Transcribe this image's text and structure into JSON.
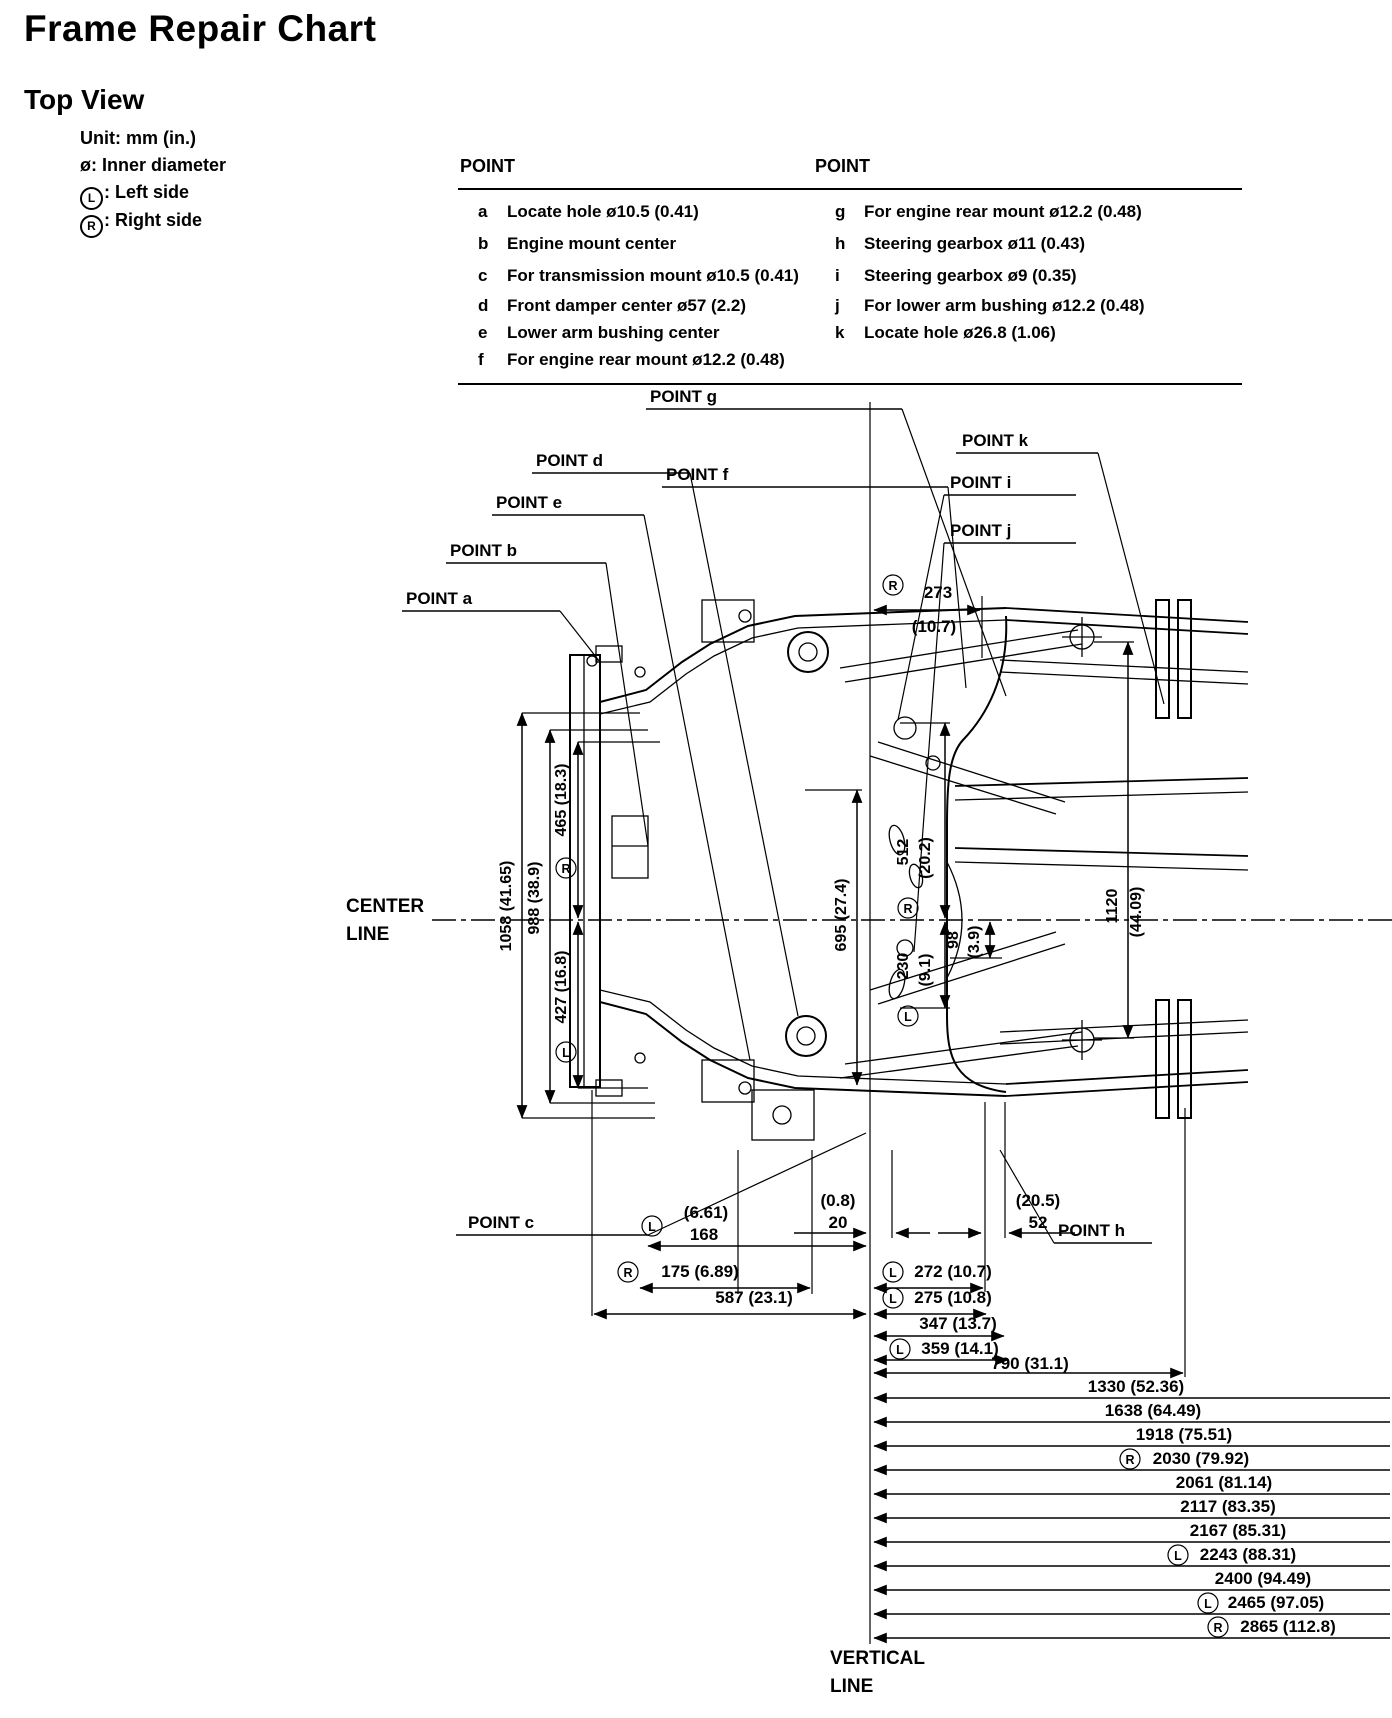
{
  "page": {
    "title": "Frame Repair Chart",
    "subtitle": "Top View"
  },
  "legend": {
    "unit": "Unit: mm (in.)",
    "diameter": "ø: Inner diameter",
    "left_symbol": "L",
    "left_label": ": Left side",
    "right_symbol": "R",
    "right_label": ": Right side"
  },
  "table": {
    "left_header": "POINT",
    "right_header": "POINT",
    "left_rows": [
      {
        "key": "a",
        "desc": "Locate hole ø10.5 (0.41)"
      },
      {
        "key": "b",
        "desc": "Engine mount center"
      },
      {
        "key": "c",
        "desc": "For transmission mount ø10.5 (0.41)"
      },
      {
        "key": "d",
        "desc": "Front damper center ø57 (2.2)"
      },
      {
        "key": "e",
        "desc": "Lower arm bushing center"
      },
      {
        "key": "f",
        "desc": "For engine rear mount ø12.2 (0.48)"
      }
    ],
    "right_rows": [
      {
        "key": "g",
        "desc": "For engine rear mount ø12.2 (0.48)"
      },
      {
        "key": "h",
        "desc": "Steering gearbox ø11 (0.43)"
      },
      {
        "key": "i",
        "desc": "Steering gearbox ø9 (0.35)"
      },
      {
        "key": "j",
        "desc": "For lower arm bushing ø12.2 (0.48)"
      },
      {
        "key": "k",
        "desc": "Locate hole ø26.8 (1.06)"
      }
    ]
  },
  "diagram": {
    "center_line_1": "CENTER",
    "center_line_2": "LINE",
    "vertical_line_1": "VERTICAL",
    "vertical_line_2": "LINE",
    "points": {
      "a": "POINT a",
      "b": "POINT b",
      "c": "POINT c",
      "d": "POINT d",
      "e": "POINT e",
      "f": "POINT f",
      "g": "POINT g",
      "h": "POINT h",
      "i": "POINT i",
      "j": "POINT j",
      "k": "POINT k"
    },
    "dims": {
      "d273": {
        "side": "R",
        "value": "273",
        "inches": "(10.7)"
      },
      "d1058": {
        "value": "1058 (41.65)"
      },
      "d988": {
        "value": "988 (38.9)"
      },
      "d465": {
        "side": "R",
        "value": "465 (18.3)"
      },
      "d427": {
        "side": "L",
        "value": "427 (16.8)"
      },
      "d695": {
        "value": "695 (27.4)"
      },
      "d512": {
        "side": "R",
        "value": "512",
        "inches": "(20.2)"
      },
      "d98": {
        "value": "98",
        "inches": "(3.9)"
      },
      "d230": {
        "side": "L",
        "value": "230",
        "inches": "(9.1)"
      },
      "d1120": {
        "value": "1120",
        "inches": "(44.09)"
      },
      "d20": {
        "value": "20",
        "inches": "(0.8)"
      },
      "d52": {
        "value": "52",
        "inches": "(20.5)"
      },
      "d168": {
        "side": "L",
        "value": "168",
        "inches": "(6.61)"
      },
      "d175": {
        "side": "R",
        "value": "175 (6.89)"
      },
      "d272": {
        "side": "L",
        "value": "272 (10.7)"
      },
      "d587": {
        "value": "587 (23.1)"
      },
      "d275": {
        "side": "L",
        "value": "275 (10.8)"
      },
      "d347": {
        "value": "347 (13.7)"
      },
      "d359": {
        "side": "L",
        "value": "359 (14.1)"
      },
      "d790": {
        "value": "790 (31.1)"
      },
      "chain": [
        {
          "value": "1330 (52.36)"
        },
        {
          "value": "1638 (64.49)"
        },
        {
          "value": "1918 (75.51)"
        },
        {
          "side": "R",
          "value": "2030 (79.92)"
        },
        {
          "value": "2061 (81.14)"
        },
        {
          "value": "2117 (83.35)"
        },
        {
          "value": "2167 (85.31)"
        },
        {
          "side": "L",
          "value": "2243 (88.31)"
        },
        {
          "value": "2400 (94.49)"
        },
        {
          "side": "L",
          "value": "2465 (97.05)"
        },
        {
          "side": "R",
          "value": "2865 (112.8)"
        }
      ]
    }
  }
}
